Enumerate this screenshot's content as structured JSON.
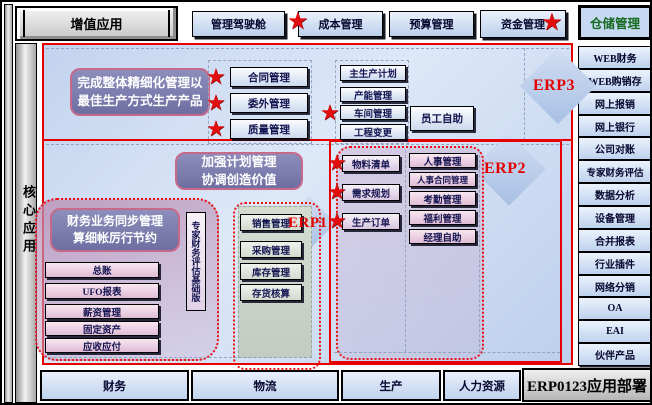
{
  "top_bar": {
    "value_add_tab": "增值应用",
    "items": [
      "管理驾驶舱",
      "成本管理",
      "预算管理",
      "资金管理",
      "仓储管理"
    ]
  },
  "left_rail": {
    "core_label": "核心应用"
  },
  "zones": {
    "erp3": {
      "label": "ERP3",
      "callout_line1": "完成整体精细化管理以",
      "callout_line2": "最佳生产方式生产产品",
      "starred_modules": [
        "合同管理",
        "委外管理",
        "质量管理"
      ],
      "plan_modules": [
        "主生产计划",
        "产能管理",
        "车间管理",
        "工程变更"
      ],
      "self_service": "员工自助"
    },
    "erp2": {
      "label": "ERP2",
      "callout_line1": "加强计划管理",
      "callout_line2": "协调创造价值",
      "starred_modules": [
        "物料清单",
        "需求规划",
        "生产订单"
      ],
      "hr_modules": [
        "人事管理",
        "人事合同管理",
        "考勤管理",
        "福利管理",
        "经理自助"
      ]
    },
    "erp1": {
      "label": "ERP1",
      "callout_line1": "财务业务同步管理",
      "callout_line2": "算细帐厉行节约",
      "expert_vertical": "专家财务评估基础版",
      "finance_modules": [
        "总账",
        "UFO报表",
        "薪资管理",
        "固定资产",
        "应收应付"
      ],
      "scm_modules": [
        "销售管理",
        "采购管理",
        "库存管理",
        "存货核算"
      ]
    }
  },
  "right_rail": {
    "items": [
      "WEB财务",
      "WEB购销存",
      "网上报销",
      "网上银行",
      "公司对账",
      "专家财务评估",
      "数据分析",
      "设备管理",
      "合并报表",
      "行业插件",
      "网络分销",
      "OA",
      "EAI",
      "伙伴产品"
    ]
  },
  "bottom_bar": {
    "items": [
      "财务",
      "物流",
      "生产",
      "人力资源"
    ],
    "deploy_label": "ERP0123应用部署"
  },
  "colors": {
    "accent_red": "#e60000",
    "star_red": "#e20d0d",
    "callout_purple": "#7d7dae",
    "highlight_green": "#14691e"
  }
}
